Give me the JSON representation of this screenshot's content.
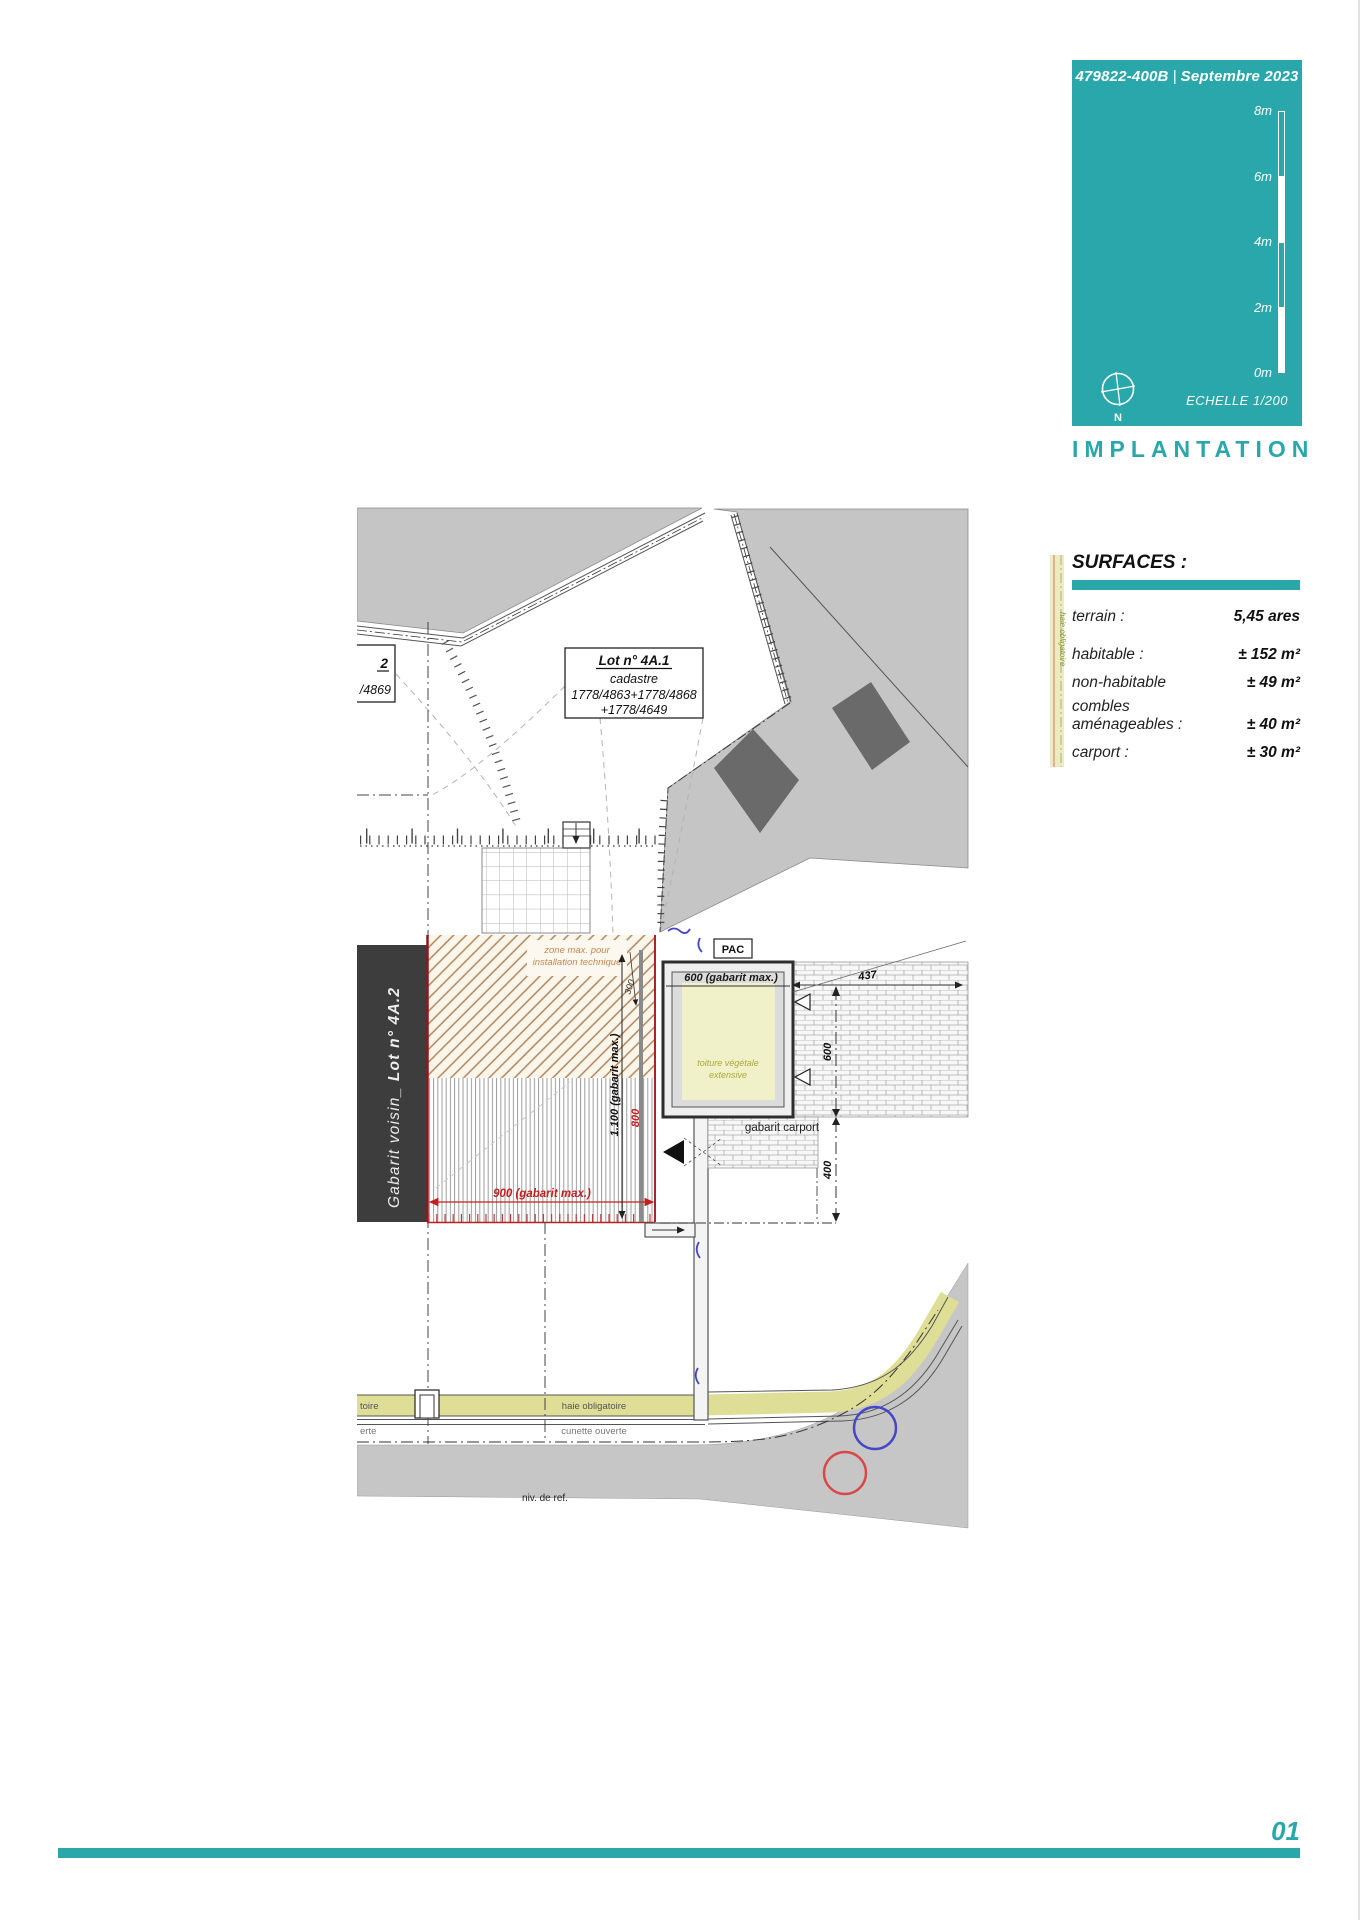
{
  "header": {
    "doc_ref": "479822-400B",
    "separator": "|",
    "date": "Septembre 2023",
    "scale_ticks": [
      "8m",
      "6m",
      "4m",
      "2m",
      "0m"
    ],
    "north": "N",
    "scale_caption": "ECHELLE  1/200",
    "sheet_title": "IMPLANTATION"
  },
  "surfaces": {
    "title": "SURFACES :",
    "rows": [
      {
        "label": "terrain :",
        "value": "5,45 ares"
      },
      {
        "label": "habitable :",
        "value": "± 152 m²"
      },
      {
        "label": "non-habitable",
        "value": "± 49 m²"
      },
      {
        "label": "combles",
        "label2": "aménageables :",
        "value": "± 40 m²"
      },
      {
        "label": "carport :",
        "value": "± 30 m²"
      }
    ]
  },
  "plan": {
    "lot_box": {
      "title": "Lot n° 4A.1",
      "sub": "cadastre",
      "parcels1": "1778/4863+1778/4868",
      "parcels2": "+1778/4649"
    },
    "neighbor_box": {
      "num": "2",
      "parcel": "/4869"
    },
    "neighbor_gabarit": {
      "prefix": "Gabarit voisin_ ",
      "lot": "Lot n° 4A.2"
    },
    "zone_max": {
      "line1": "zone max. pour",
      "line2": "installation technique"
    },
    "pac": "PAC",
    "carport": {
      "gabarit": "600 (gabarit max.)",
      "roof_line1": "toiture végétale",
      "roof_line2": "extensive",
      "caption": "gabarit carport"
    },
    "dims": {
      "d437": "437",
      "d600": "600",
      "d400": "400",
      "d300": "300",
      "d800": "800",
      "d900": "900 (gabarit max.)",
      "d1100": "1.100 (gabarit max.)"
    },
    "hedge_label": "haie obligatoire",
    "hedge_fragment": "toire",
    "hedge_right_label": "haie obligatoire",
    "gutter_label": "cunette ouverte",
    "gutter_fragment": "erte",
    "ref_level": "niv. de ref."
  },
  "footer": {
    "page": "01"
  },
  "colors": {
    "teal": "#29A7AB",
    "hedge_green": "#DEDE96",
    "roof_yellow": "#F1F1C9",
    "dim_red": "#C02020",
    "marker_blue": "#4646C8",
    "marker_red": "#D84848",
    "site_gray": "#C5C5C5",
    "building_gray": "#6A6A6A",
    "neighbor_dark": "#3D3D3D",
    "hatch_brown": "#AD7F55"
  }
}
